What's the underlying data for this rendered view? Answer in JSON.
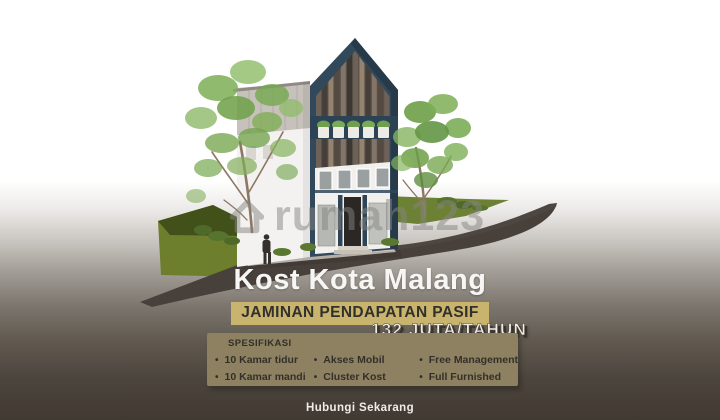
{
  "poster": {
    "title": "Kost Kota Malang",
    "guarantee_badge": "JAMINAN PENDAPATAN PASIF",
    "price": "132 JUTA/TAHUN",
    "specs": {
      "heading": "SPESIFIKASI",
      "columns": [
        {
          "items": [
            "10 Kamar tidur",
            "10 Kamar mandi"
          ]
        },
        {
          "items": [
            "Akses Mobil",
            "Cluster Kost"
          ]
        },
        {
          "items": [
            "Free Management",
            "Full Furnished"
          ]
        }
      ]
    },
    "contact_cta": "Hubungi Sekarang",
    "watermark": "rumah123"
  },
  "colors": {
    "badge_bg": "#c8b46d",
    "specs_panel_bg": "#8d8161",
    "building_teal": "#32495c",
    "background_bottom": "#413a32",
    "grass_green": "#6d7e2c",
    "road_asphalt": "#48403b"
  }
}
